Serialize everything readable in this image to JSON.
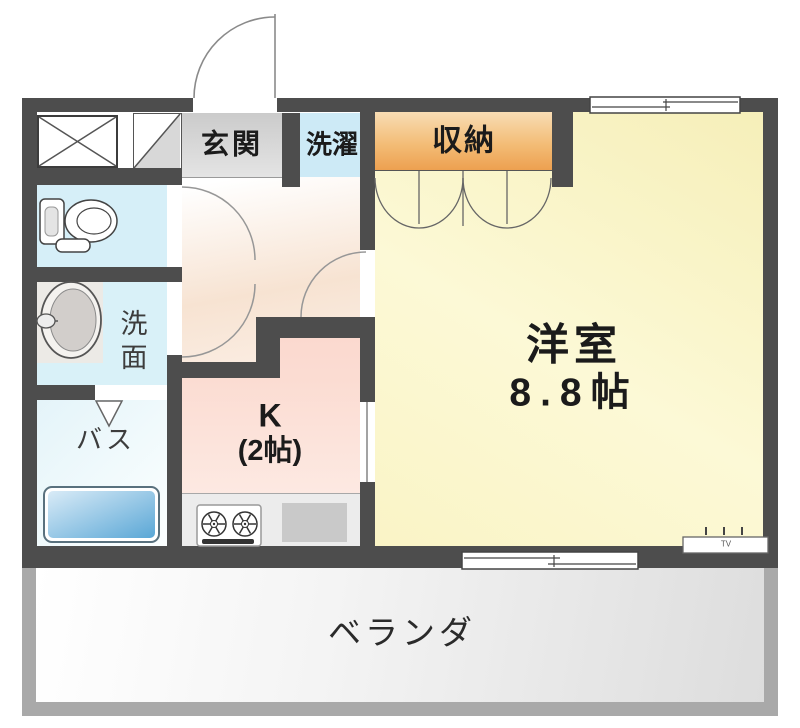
{
  "plan": {
    "type": "apartment-floor-plan",
    "rooms": {
      "genkan_label": "玄関",
      "laundry_label": "洗濯",
      "storage_label": "収納",
      "western_room_label": "洋室",
      "western_room_size": "8.8帖",
      "kitchen_label": "K",
      "kitchen_size": "(2帖)",
      "bath_label": "バス",
      "washroom_label": "洗面",
      "veranda_label": "ベランダ",
      "tv_marker_label": "TV"
    },
    "icons": [
      "entrance-door-arc-icon",
      "toilet-icon",
      "washbasin-icon",
      "bathtub-icon",
      "stove-icon",
      "folding-door-icon",
      "closet-doors-icon",
      "sliding-window-icon",
      "sliding-door-icon",
      "cross-box-icon",
      "diagonal-shoe-cabinet-icon",
      "tv-outlet-icon",
      "interior-door-arc-icon"
    ],
    "colors": {
      "wall": "#4d4d4d",
      "western_room_yellow": "#faf5c8",
      "kitchen_pink": "#fbded5",
      "water_area_cyan": "#d4edf7",
      "storage_orange": "#eda050",
      "genkan_gray": "#d6d6d6",
      "bathtub_blue": "#5aa7d6",
      "balcony_frame_gray": "#a9a9a9",
      "hallway_peach": "#f7e3d2"
    }
  }
}
